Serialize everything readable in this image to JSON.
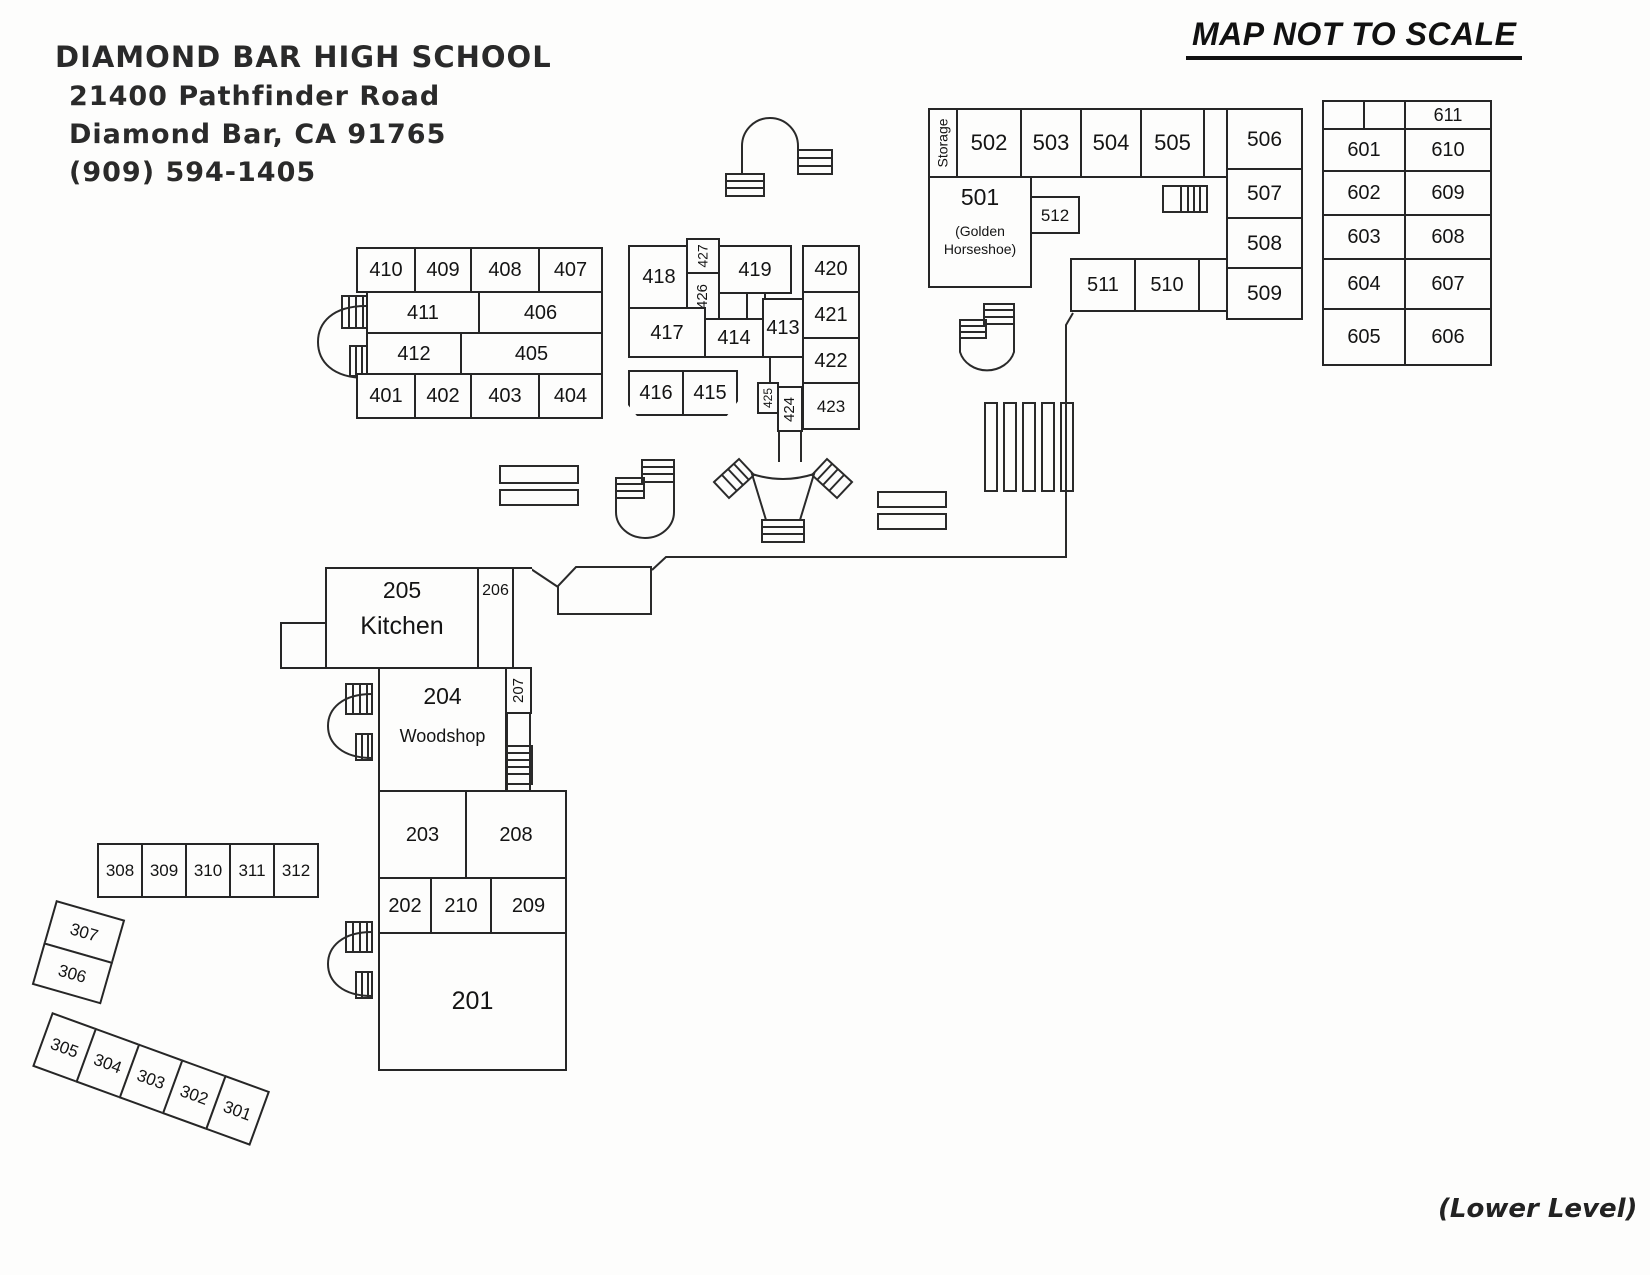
{
  "header": {
    "school": "DIAMOND BAR HIGH SCHOOL",
    "address1": "21400 Pathfinder Road",
    "address2": "Diamond Bar, CA 91765",
    "phone": "(909) 594-1405"
  },
  "notes": {
    "scale": "MAP NOT TO SCALE",
    "level": "(Lower Level)"
  },
  "rooms": {
    "r201": "201",
    "r202": "202",
    "r203": "203",
    "r204": "204",
    "woodshop": "Woodshop",
    "r205": "205",
    "kitchen": "Kitchen",
    "r206": "206",
    "r207": "207",
    "r208": "208",
    "r209": "209",
    "r210": "210",
    "r301": "301",
    "r302": "302",
    "r303": "303",
    "r304": "304",
    "r305": "305",
    "r306": "306",
    "r307": "307",
    "r308": "308",
    "r309": "309",
    "r310": "310",
    "r311": "311",
    "r312": "312",
    "r401": "401",
    "r402": "402",
    "r403": "403",
    "r404": "404",
    "r405": "405",
    "r406": "406",
    "r407": "407",
    "r408": "408",
    "r409": "409",
    "r410": "410",
    "r411": "411",
    "r412": "412",
    "r413": "413",
    "r414": "414",
    "r415": "415",
    "r416": "416",
    "r417": "417",
    "r418": "418",
    "r419": "419",
    "r420": "420",
    "r421": "421",
    "r422": "422",
    "r423": "423",
    "r424": "424",
    "r425": "425",
    "r426": "426",
    "r427": "427",
    "storage": "Storage",
    "r501": "501",
    "golden": "(Golden Horseshoe)",
    "r502": "502",
    "r503": "503",
    "r504": "504",
    "r505": "505",
    "r506": "506",
    "r507": "507",
    "r508": "508",
    "r509": "509",
    "r510": "510",
    "r511": "511",
    "r512": "512",
    "r601": "601",
    "r602": "602",
    "r603": "603",
    "r604": "604",
    "r605": "605",
    "r606": "606",
    "r607": "607",
    "r608": "608",
    "r609": "609",
    "r610": "610",
    "r611": "611"
  }
}
